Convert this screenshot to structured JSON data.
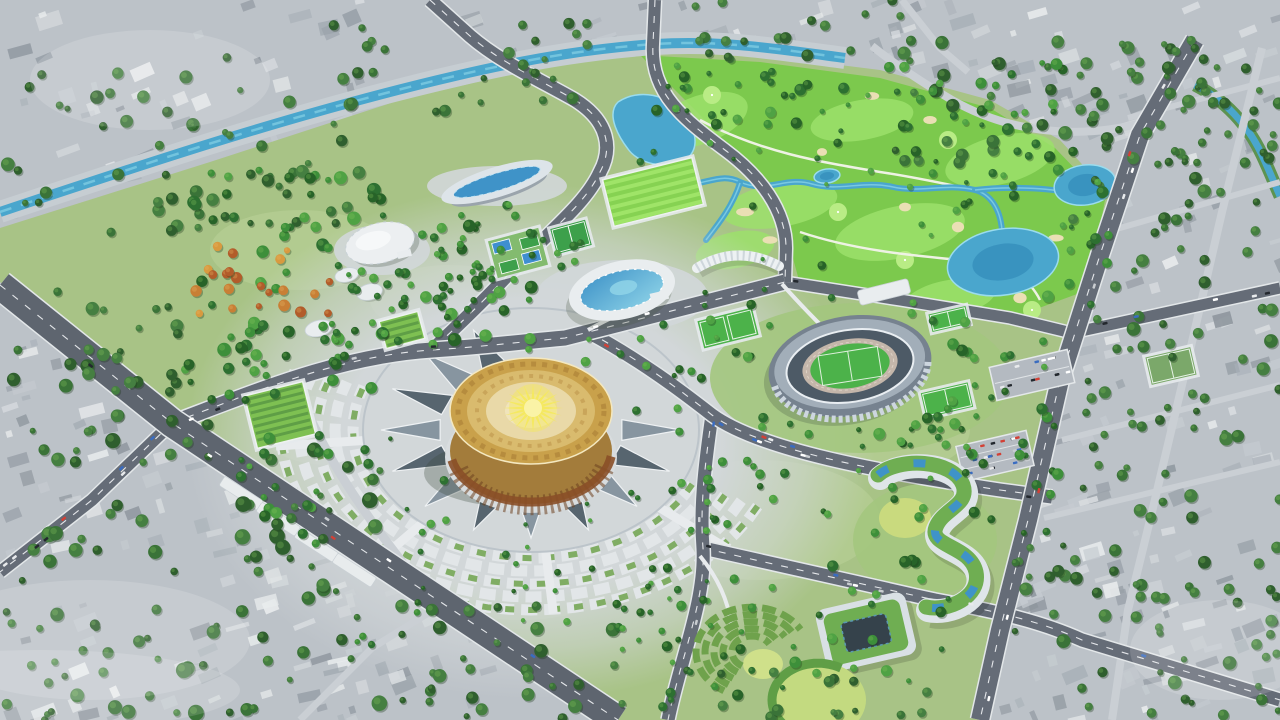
{
  "meta": {
    "type": "3d-aerial-architectural-rendering",
    "subject": "Master plan bird's-eye rendering: sports-and-culture park with golden bronze-drum arena, athletics stadium, aquatic center, golf course and gray surrounding city"
  },
  "palette": {
    "city_base": "#bcc2c8",
    "city_quads": [
      "#a9b1b8",
      "#c6ccd1",
      "#98a0a8",
      "#d8dcdf",
      "#8d959d",
      "#e9eced"
    ],
    "city_tree": [
      "#3a7338",
      "#2f5f2e",
      "#457f41"
    ],
    "park_base": "#a8c386",
    "park_light": "#bcd49a",
    "park_tree": [
      "#2d7031",
      "#3d8f3a",
      "#4fa244",
      "#276328"
    ],
    "autumn_tree": [
      "#c87f35",
      "#d89a3f",
      "#b25c2a"
    ],
    "golf_base": "#7cc94d",
    "golf_light": "#9ce06b",
    "golf_green": "#b9ec85",
    "bunker": "#eadfb4",
    "water": "#4aa6cd",
    "water_deep": "#2f87b5",
    "water_light": "#8fd8ea",
    "road": "#656c77",
    "road_major": "#5e656f",
    "road_minor": "#cacfd4",
    "road_edge": "#e3e7e9",
    "road_line": "#f2f4f6",
    "plaza": "#d2d7d9",
    "tri_dark": "#57656f",
    "tri_mid": "#8795a0",
    "tri_light": "#eef1f3",
    "arc_bed": "#e2e6e8",
    "hedge": "#6fa24c",
    "lawn": "#a3c67e",
    "lawn_bright": "#c3da80",
    "gold_rim": "#c9a14b",
    "gold_mid": "#d9bb6e",
    "gold_pale": "#e9d9a8",
    "gold_center": "#f0e4bb",
    "bronze": "#a37c3b",
    "band": "#8a4f28",
    "band_dark": "#6d4220",
    "sun": "#f4e95e",
    "sun_core": "#faf3a6",
    "stand": "#76828f",
    "stand_light": "#a2aeb9",
    "stand_dark": "#4d5a66",
    "track": "#c4b6aa",
    "pitch": "#4cb24a",
    "white_bldg": "#e9edef",
    "glass": "#3f93c8",
    "glass_light": "#8fd4e8",
    "roof_green": "#6fae52",
    "court_dark": "#35424b",
    "cars": [
      "#ffffff",
      "#e8eaec",
      "#c9cdd1",
      "#d24036",
      "#3a6cc0",
      "#23282e"
    ]
  },
  "scene": {
    "canvas": {
      "w": 1280,
      "h": 720
    },
    "city_regions": [
      [
        0,
        0,
        660,
        250,
        90
      ],
      [
        560,
        0,
        340,
        120,
        36
      ],
      [
        880,
        0,
        400,
        170,
        62
      ],
      [
        1030,
        150,
        250,
        420,
        70
      ],
      [
        990,
        540,
        290,
        180,
        52
      ],
      [
        0,
        260,
        200,
        170,
        30
      ],
      [
        0,
        400,
        400,
        320,
        95
      ],
      [
        260,
        520,
        380,
        200,
        48
      ],
      [
        620,
        660,
        360,
        60,
        18
      ]
    ],
    "park_polygon": "0,228 210,162 400,100 545,66 655,48 760,55 880,70 990,100 1060,140 1110,195 1090,300 1055,430 1020,560 995,665 985,720 615,720 395,570 172,423 0,282",
    "golf_polygon": "640,55 760,62 880,78 990,108 1055,148 1105,200 1088,290 1020,315 900,298 800,284 788,240 755,175 700,115",
    "park_patches": [
      [
        300,
        250,
        90,
        40
      ],
      [
        450,
        300,
        80,
        35
      ],
      [
        620,
        380,
        90,
        40
      ],
      [
        520,
        560,
        120,
        60
      ],
      [
        760,
        520,
        120,
        60
      ],
      [
        880,
        430,
        90,
        45
      ],
      [
        640,
        470,
        80,
        40
      ],
      [
        330,
        430,
        70,
        35
      ]
    ],
    "fairways": [
      [
        700,
        120,
        50,
        24,
        -20
      ],
      [
        780,
        205,
        58,
        22,
        -10
      ],
      [
        900,
        232,
        66,
        26,
        -12
      ],
      [
        1000,
        160,
        56,
        24,
        -14
      ],
      [
        862,
        120,
        52,
        20,
        -10
      ],
      [
        950,
        298,
        46,
        18,
        -10
      ],
      [
        735,
        250,
        40,
        18,
        -12
      ]
    ],
    "golf_greens": [
      [
        712,
        95
      ],
      [
        838,
        212
      ],
      [
        948,
        140
      ],
      [
        1032,
        310
      ],
      [
        905,
        260
      ]
    ],
    "bunkers": [
      [
        745,
        212
      ],
      [
        822,
        152
      ],
      [
        905,
        207
      ],
      [
        958,
        227
      ],
      [
        1020,
        298
      ],
      [
        872,
        96
      ],
      [
        1056,
        238
      ],
      [
        770,
        240
      ],
      [
        930,
        120
      ]
    ],
    "cart_paths": [
      "M700,120 C760,152 820,162 880,172 C920,178 950,185 975,190",
      "M800,232 C860,252 920,256 980,262 C1010,265 1030,280 1040,300"
    ],
    "canal": "M0,212 C150,162 300,112 455,76 C540,56 600,48 655,44 C720,40 770,48 845,58",
    "city_canal": "M1195,85 C1225,100 1248,125 1262,155 C1270,172 1275,185 1280,196",
    "rivers": [
      "M648,150 C660,166 656,176 670,181 C700,192 716,170 740,182 C766,194 786,176 812,184 C840,192 862,180 893,187 C920,193 946,183 975,190 C990,194 1000,208 1002,230",
      "M740,183 C733,205 720,222 706,240",
      "M975,190 C1008,186 1048,188 1072,193"
    ],
    "lakes": [
      {
        "type": "path",
        "d": "M618,102 C640,88 668,95 681,112 C696,128 700,146 688,158 C672,170 640,166 628,149 C618,136 606,114 618,102"
      },
      {
        "type": "ellipse",
        "cx": 1003,
        "cy": 262,
        "rx": 56,
        "ry": 33,
        "rot": -9
      },
      {
        "type": "ellipse",
        "cx": 1085,
        "cy": 185,
        "rx": 31,
        "ry": 20,
        "rot": -8
      },
      {
        "type": "ellipse",
        "cx": 827,
        "cy": 176,
        "rx": 13,
        "ry": 7,
        "rot": -8
      }
    ],
    "roads": [
      {
        "name": "city-street-cross-1",
        "d": "M1128,118 L1280,78",
        "w": 6,
        "minor": true
      },
      {
        "name": "city-street-cross-2",
        "d": "M1106,232 L1280,182",
        "w": 6,
        "minor": true
      },
      {
        "name": "city-street-cross-3",
        "d": "M1062,440 L1280,385",
        "w": 6,
        "minor": true
      },
      {
        "name": "city-street-cross-4",
        "d": "M1044,518 L1280,462",
        "w": 6,
        "minor": true
      },
      {
        "name": "city-avenue-parallel",
        "d": "M1262,48 L1222,212 L1186,368 L1152,512 L1128,610 L1112,720",
        "w": 8,
        "minor": true
      },
      {
        "name": "golf-northeast-road",
        "d": "M1152,120 C1080,142 1008,132 952,100 C918,80 892,62 872,46",
        "w": 8,
        "minor": true
      },
      {
        "name": "city-street-top",
        "d": "M902,0 L940,48 L968,72",
        "w": 7,
        "minor": true
      },
      {
        "name": "city-street-bottom-left",
        "d": "M300,720 L372,648 L430,612",
        "w": 7,
        "minor": true
      },
      {
        "name": "plaza-west-ring-road",
        "d": "M298,390 C320,445 352,498 403,563",
        "w": 9,
        "minor": true
      },
      {
        "name": "southwest-cross-road",
        "d": "M172,423 L92,500 L0,572",
        "w": 12
      },
      {
        "name": "south-east-road",
        "d": "M703,548 C790,568 862,584 935,600 C1000,612 1042,622 1082,640 L1280,700",
        "w": 13
      },
      {
        "name": "golf-south-road",
        "d": "M785,282 L900,300 L1010,318 L1072,333 L1280,288",
        "w": 11
      },
      {
        "name": "south-park-road",
        "d": "M712,415 C704,470 700,510 703,548 C706,600 680,660 668,720",
        "w": 13
      },
      {
        "name": "plaza-ring-road",
        "d": "M588,332 C640,360 680,390 712,415 C760,450 880,472 1000,490 L1052,497",
        "w": 13
      },
      {
        "name": "park-s-curve-road",
        "d": "M430,0 L470,36 C500,62 540,80 575,100 C610,122 612,150 600,172 C585,205 548,232 505,278 C480,305 455,328 432,350",
        "w": 13
      },
      {
        "name": "golf-west-road",
        "d": "M655,0 L653,44 C650,94 685,120 725,150 C760,176 786,210 786,248 L785,282",
        "w": 12
      },
      {
        "name": "east-west-road",
        "d": "M172,423 C260,390 340,356 432,350 C490,346 520,342 565,338 L785,282",
        "w": 15
      },
      {
        "name": "east-avenue",
        "d": "M1195,40 L1140,135 L1100,255 L1060,380 L1028,520 L1000,630 L980,720",
        "w": 18
      },
      {
        "name": "southwest-boulevard",
        "d": "M0,285 L172,423 L400,575 L618,720",
        "w": 28
      }
    ],
    "car_roads": [
      "southwest-boulevard",
      "east-west-road",
      "east-avenue",
      "plaza-ring-road",
      "south-east-road",
      "golf-south-road",
      "southwest-cross-road",
      "south-park-road"
    ],
    "car_count": 54,
    "park_paths": [
      "M588,330 C610,318 626,310 648,304",
      "M782,284 C812,318 836,340 852,356",
      "M700,556 C718,578 728,600 731,624"
    ],
    "plaza": {
      "cx": 531,
      "cy": 430,
      "sy": 0.72,
      "grad_rx": 345,
      "grad_ry": 258,
      "inner_rx": 168,
      "inner_ry": 122,
      "tri_r0": 92,
      "tri_r1": 150,
      "tri_n": 16,
      "tri_gap": [
        250,
        345
      ],
      "arc_radii": [
        160,
        178,
        196,
        214,
        232,
        250
      ],
      "arc_a0": 25,
      "arc_a1": 200,
      "spokes": [
        40,
        85,
        130,
        175
      ],
      "spoke_r0": 88,
      "spoke_r1": 256
    },
    "pads": [
      {
        "cx": 622,
        "cy": 296,
        "rx": 86,
        "ry": 36,
        "fill": "plaza"
      },
      {
        "cx": 860,
        "cy": 378,
        "rx": 150,
        "ry": 75,
        "fill": "lawn"
      },
      {
        "cx": 497,
        "cy": 186,
        "rx": 70,
        "ry": 20,
        "fill": "plaza"
      },
      {
        "cx": 382,
        "cy": 250,
        "rx": 48,
        "ry": 25,
        "fill": "plaza"
      },
      {
        "cx": 925,
        "cy": 540,
        "rx": 72,
        "ry": 56,
        "fill": "lawn"
      }
    ],
    "fields": [
      {
        "cx": 571,
        "cy": 237,
        "w": 36,
        "h": 26,
        "rot": -15,
        "type": "courts-green"
      },
      {
        "cx": 653,
        "cy": 192,
        "w": 92,
        "h": 48,
        "rot": -14,
        "type": "striped"
      },
      {
        "cx": 518,
        "cy": 253,
        "w": 52,
        "h": 38,
        "rot": -15,
        "type": "tennis"
      },
      {
        "cx": 728,
        "cy": 328,
        "w": 56,
        "h": 28,
        "rot": -14,
        "type": "pitch2"
      },
      {
        "cx": 947,
        "cy": 400,
        "w": 48,
        "h": 25,
        "rot": -13,
        "type": "pitch"
      },
      {
        "cx": 949,
        "cy": 319,
        "w": 38,
        "h": 18,
        "rot": -13,
        "type": "pitch"
      },
      {
        "cx": 1171,
        "cy": 366,
        "w": 46,
        "h": 28,
        "rot": -13,
        "type": "pitch-pale"
      },
      {
        "cx": 280,
        "cy": 415,
        "w": 60,
        "h": 54,
        "rot": -14,
        "type": "hedge"
      },
      {
        "cx": 402,
        "cy": 330,
        "w": 40,
        "h": 28,
        "rot": -15,
        "type": "hedge"
      }
    ],
    "parking": [
      {
        "cx": 1032,
        "cy": 375,
        "w": 80,
        "h": 34,
        "rot": -13
      },
      {
        "cx": 995,
        "cy": 456,
        "w": 72,
        "h": 36,
        "rot": -13
      }
    ],
    "colonnades": [
      [
        225,
        476
      ],
      [
        262,
        502
      ],
      [
        300,
        528
      ],
      [
        338,
        553
      ]
    ],
    "drum": {
      "cx": 531,
      "top_cy": 411,
      "rx": 81,
      "ry": 53,
      "bot_cy": 451,
      "sun_cx": 533,
      "sun_cy": 408
    },
    "stadium": {
      "cx": 850,
      "cy": 366,
      "rot": -9
    },
    "aquatic": {
      "cx": 622,
      "cy": 290,
      "rot": -13
    },
    "lens": {
      "cx": 497,
      "cy": 182,
      "rot": -17
    },
    "dome": {
      "cx": 380,
      "cy": 243,
      "rot": -14,
      "pavilions": [
        [
          340,
          266,
          12,
          7
        ],
        [
          358,
          288,
          13,
          8
        ],
        [
          300,
          311,
          14,
          8
        ]
      ]
    },
    "shell": {
      "d": "M697,268 Q737,244 779,266"
    },
    "white_row": {
      "cx": 884,
      "cy": 292,
      "w": 52,
      "h": 15,
      "rot": -14
    },
    "curved": {
      "base": "M880,478 C900,460 955,462 965,488 C972,508 945,512 938,530 C930,550 972,548 978,575 C983,600 950,615 928,610",
      "court": {
        "cx": 905,
        "cy": 518,
        "rx": 26,
        "ry": 20
      }
    },
    "courtyard": {
      "x": 820,
      "y": 600,
      "w": 92,
      "h": 64,
      "rot": -13,
      "cx": 866,
      "cy": 632
    },
    "amphi": {
      "cx": 752,
      "cy": 652,
      "radii": [
        20,
        29,
        38,
        47,
        56
      ],
      "a0": 120,
      "a1": 330,
      "lawn": {
        "cx": 818,
        "cy": 700,
        "rx": 48,
        "ry": 38
      },
      "lawn2": {
        "cx": 763,
        "cy": 664,
        "rx": 20,
        "ry": 15
      }
    },
    "tree_clusters": [
      [
        0,
        55,
        360,
        190,
        58,
        3,
        7,
        "c"
      ],
      [
        330,
        20,
        260,
        95,
        30,
        3,
        6,
        "c"
      ],
      [
        690,
        0,
        220,
        60,
        18,
        3,
        6,
        "c"
      ],
      [
        890,
        25,
        330,
        140,
        62,
        3,
        7,
        "c"
      ],
      [
        1060,
        160,
        220,
        360,
        68,
        3,
        7,
        "c"
      ],
      [
        1150,
        60,
        130,
        100,
        18,
        3,
        6,
        "c"
      ],
      [
        1010,
        545,
        270,
        175,
        56,
        3,
        7,
        "c"
      ],
      [
        0,
        290,
        180,
        150,
        28,
        3,
        7,
        "c"
      ],
      [
        0,
        420,
        390,
        300,
        98,
        3,
        8,
        "c"
      ],
      [
        395,
        600,
        220,
        120,
        30,
        3,
        7,
        "c"
      ],
      [
        620,
        670,
        330,
        50,
        16,
        3,
        6,
        "c"
      ],
      [
        185,
        165,
        350,
        185,
        82,
        3,
        7,
        "p"
      ],
      [
        185,
        320,
        190,
        85,
        26,
        3,
        6,
        "p"
      ],
      [
        195,
        245,
        135,
        70,
        22,
        3,
        6,
        "a"
      ],
      [
        330,
        230,
        170,
        115,
        30,
        2.5,
        5,
        "p"
      ],
      [
        440,
        200,
        150,
        80,
        22,
        2.5,
        5,
        "p"
      ],
      [
        580,
        290,
        200,
        95,
        26,
        2.5,
        5,
        "p"
      ],
      [
        760,
        300,
        210,
        150,
        40,
        2.5,
        6,
        "p"
      ],
      [
        950,
        330,
        115,
        215,
        30,
        2.5,
        6,
        "p"
      ],
      [
        650,
        55,
        430,
        100,
        50,
        2.5,
        6,
        "p"
      ],
      [
        1010,
        140,
        105,
        170,
        24,
        2.5,
        6,
        "p"
      ],
      [
        630,
        100,
        420,
        200,
        36,
        2,
        4.5,
        "p"
      ],
      [
        620,
        560,
        330,
        150,
        46,
        2.5,
        6,
        "p"
      ],
      [
        350,
        380,
        360,
        270,
        52,
        2,
        4.5,
        "p"
      ],
      [
        700,
        420,
        240,
        120,
        30,
        2.5,
        5,
        "p"
      ],
      [
        240,
        430,
        130,
        120,
        20,
        2.5,
        6,
        "p"
      ]
    ],
    "exclusions": [
      [
        531,
        430,
        104,
        76
      ],
      [
        850,
        366,
        100,
        62
      ],
      [
        622,
        290,
        62,
        34
      ],
      [
        380,
        243,
        44,
        27
      ],
      [
        497,
        182,
        66,
        20
      ],
      [
        1003,
        262,
        62,
        38
      ]
    ],
    "haze": [
      [
        90,
        640,
        160,
        60
      ],
      [
        40,
        690,
        200,
        40
      ],
      [
        150,
        80,
        120,
        50
      ],
      [
        1220,
        650,
        90,
        50
      ]
    ]
  }
}
